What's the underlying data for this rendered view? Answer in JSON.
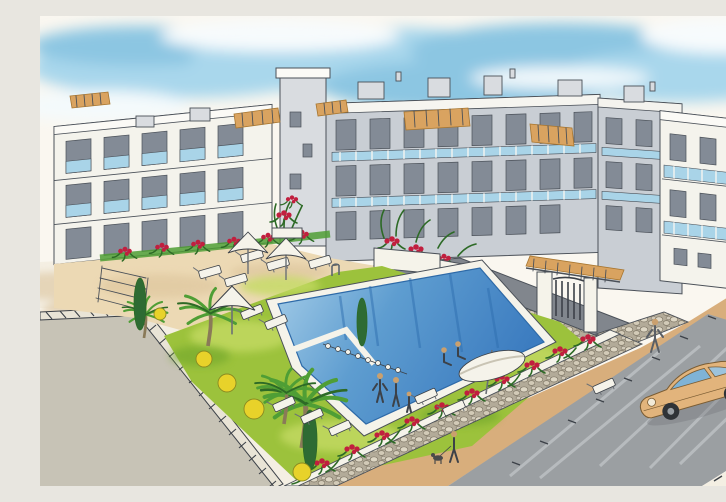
{
  "meta": {
    "title": "Watercolour architect's rendering of an apartment complex",
    "aria_label": "Hand-drawn watercolour illustration of a white Mediterranean apartment complex surrounding a garden courtyard with a large blue swimming pool, sun loungers, parasols, palm trees, red flowers, a stone perimeter wall with an iron entrance gate, and a tan sports car driving on the street in front"
  },
  "colors": {
    "paper": "#faf7f0",
    "sky1": "#a9d7ec",
    "sky2": "#8cc6e2",
    "ink": "#4a5058",
    "ink2": "#3c4148",
    "bldg-white": "#f4f3ec",
    "bldg-grey": "#c9ced4",
    "bldg-grey2": "#d9dce0",
    "win-dark": "#838b96",
    "glass-blue": "#a9d4e8",
    "terracotta": "#d9a360",
    "terracotta-dk": "#a8762f",
    "sand": "#ecd9b4",
    "shadow-tan": "#d9c096",
    "lawn": "#9cc23c",
    "lawn-light": "#c4da64",
    "pool-light": "#a5cde8",
    "pool-mid": "#5e9dd0",
    "pool-deep": "#3c7cc0",
    "coping": "#f5f3ea",
    "stone-light": "#ded7c5",
    "stone-bg": "#b3ab99",
    "wall-grey": "#81868d",
    "flower-red": "#c11f3e",
    "palm-green": "#4f9e35",
    "palm-dk": "#2d6a26",
    "cypress": "#2e6b33",
    "yellow": "#e8d22a",
    "olive": "#8a8a20",
    "trunk": "#8a7a58",
    "road": "#9b9fa2",
    "street": "#c7c3b6",
    "walk": "#f4efe3",
    "sidewalk-tan": "#d8ae7c",
    "car-tan": "#e2b47c",
    "car-line": "#7a5c33",
    "skin": "#caa06e"
  },
  "scene": {
    "style": "pen and watercolour architectural sketch",
    "sky": "soft blue watercolour washes with white clouds",
    "buildings": "U-shaped three/four-storey white and grey apartment blocks with dark recessed windows, pale-blue glass balcony balustrades, white parapets, rooftop stair boxes and terracotta pergola awnings",
    "courtyard": {
      "pool": "large rectangular pool seen in perspective with white coping, chrome ladder, buoy rope across the shallow corner, two sunbathers seated on the edge and a family of three standing on the lawn",
      "lawn": "bright green lawn surrounding the pool",
      "parasols": 4,
      "sun_loungers": 13,
      "palm_trees": 4,
      "cypress_trees": 3,
      "yellow_shrubs": 5,
      "flowers": "clusters of red geraniums along terraces, planters and the perimeter wall"
    },
    "entrance": "natural-stone perimeter wall with white cap, wrought-iron gate between white pillars under a terracotta-tiled pergola",
    "street": {
      "car": "tan classic sports coupe driving on the grey road",
      "pedestrians": "a walker on the tan sidewalk and a person with a small dog below the wall",
      "left_corner": "light grey side street with hatched kerb bands"
    }
  }
}
